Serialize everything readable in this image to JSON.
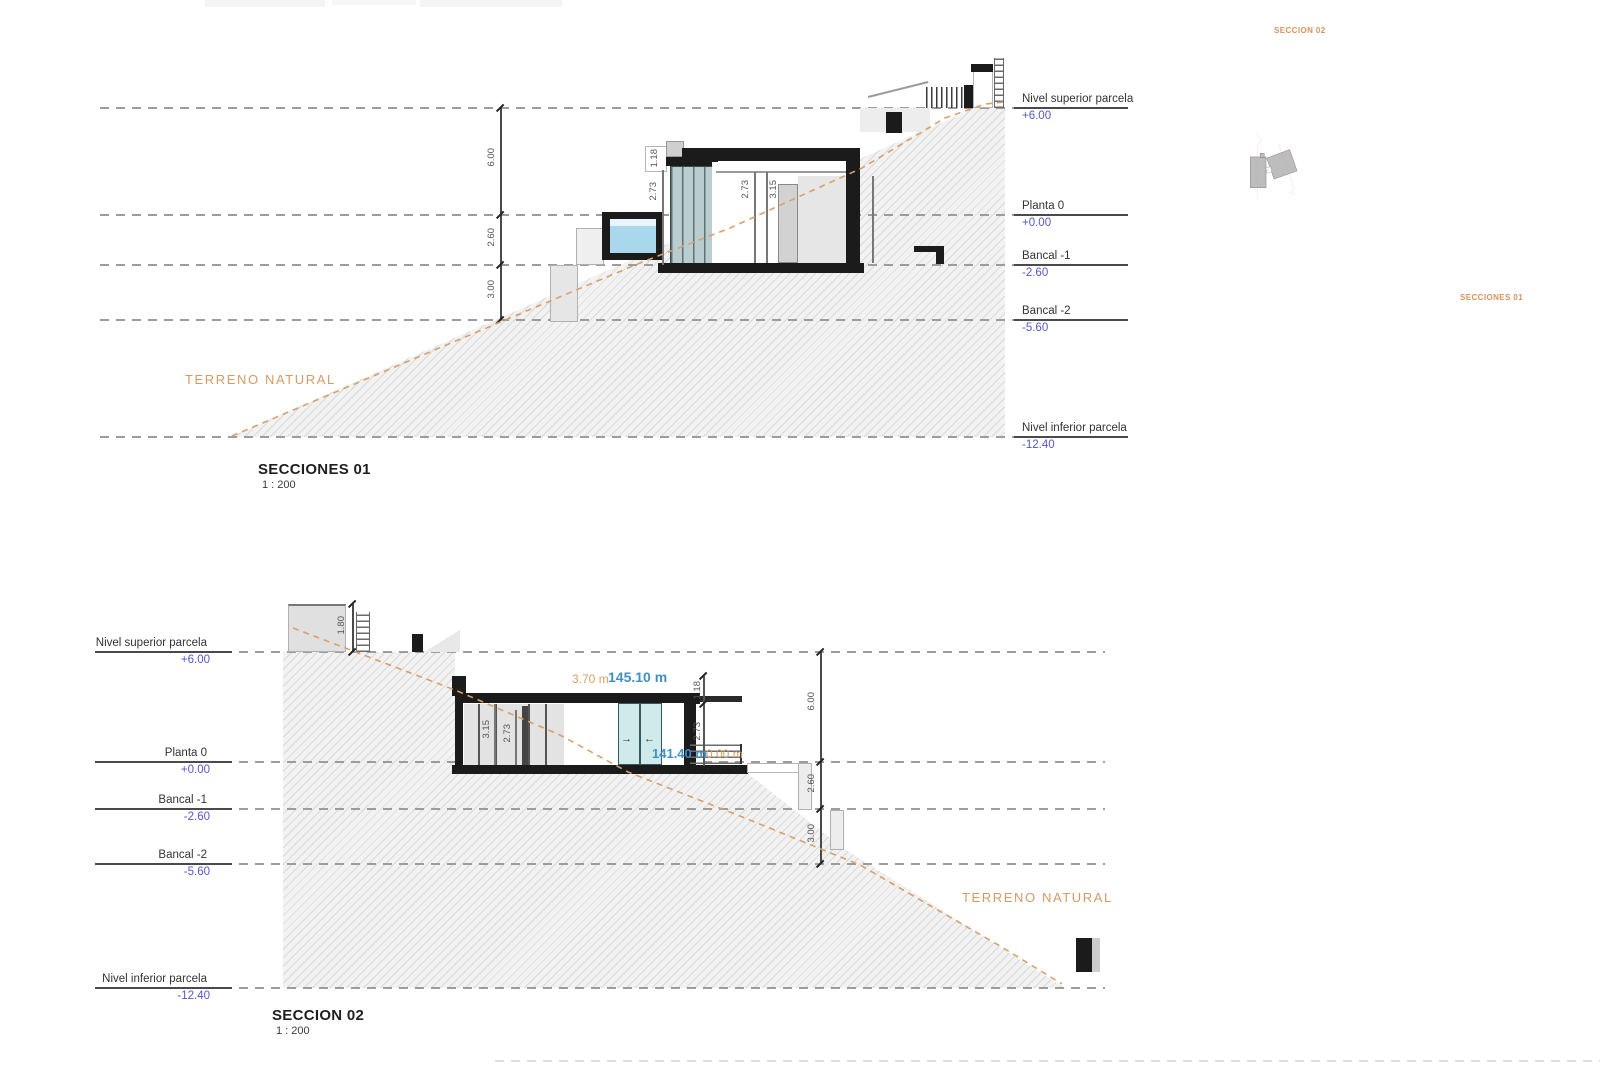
{
  "levels": [
    {
      "name": "Nivel superior parcela",
      "value": "+6.00"
    },
    {
      "name": "Planta 0",
      "value": "+0.00"
    },
    {
      "name": "Bancal -1",
      "value": "-2.60"
    },
    {
      "name": "Bancal -2",
      "value": "-5.60"
    },
    {
      "name": "Nivel inferior parcela",
      "value": "-12.40"
    }
  ],
  "section1": {
    "title": "SECCIONES 01",
    "scale": "1 : 200",
    "terrain_label": "TERRENO NATURAL",
    "vdim": {
      "seg1": "6.00",
      "seg2": "2.60",
      "seg3": "3.00"
    },
    "dims": {
      "parapet": "1.18",
      "glass_height": "2.73",
      "room_height": "2.73",
      "structure_height": "3.15"
    }
  },
  "section2": {
    "title": "SECCION 02",
    "scale": "1 : 200",
    "terrain_label": "TERRENO NATURAL",
    "vdim": {
      "seg1": "6.00",
      "seg2": "2.60",
      "seg3": "3.00"
    },
    "dims": {
      "wall_height": "1.80",
      "structure_height": "3.15",
      "room_height": "2.73",
      "parapet": "1.18",
      "right_room_height": "2.73"
    },
    "annotations": {
      "offset": "3.70 m",
      "roof_level": "145.10 m",
      "floor_level": "141.40 m",
      "zero": "0.00 m"
    },
    "door_arrows": {
      "slide_right": "→",
      "slide_left": "←"
    }
  },
  "site_plan": {
    "label_top": "SECCION 02",
    "label_bottom": "SECCIONES 01"
  },
  "colors": {
    "level_value_blue": "#5556cb",
    "terrain_orange": "#d49b66",
    "annotation_blue": "#3f90c5",
    "plan_fill": "#bdbdbd",
    "hatch_base": "#f2f2f2"
  }
}
